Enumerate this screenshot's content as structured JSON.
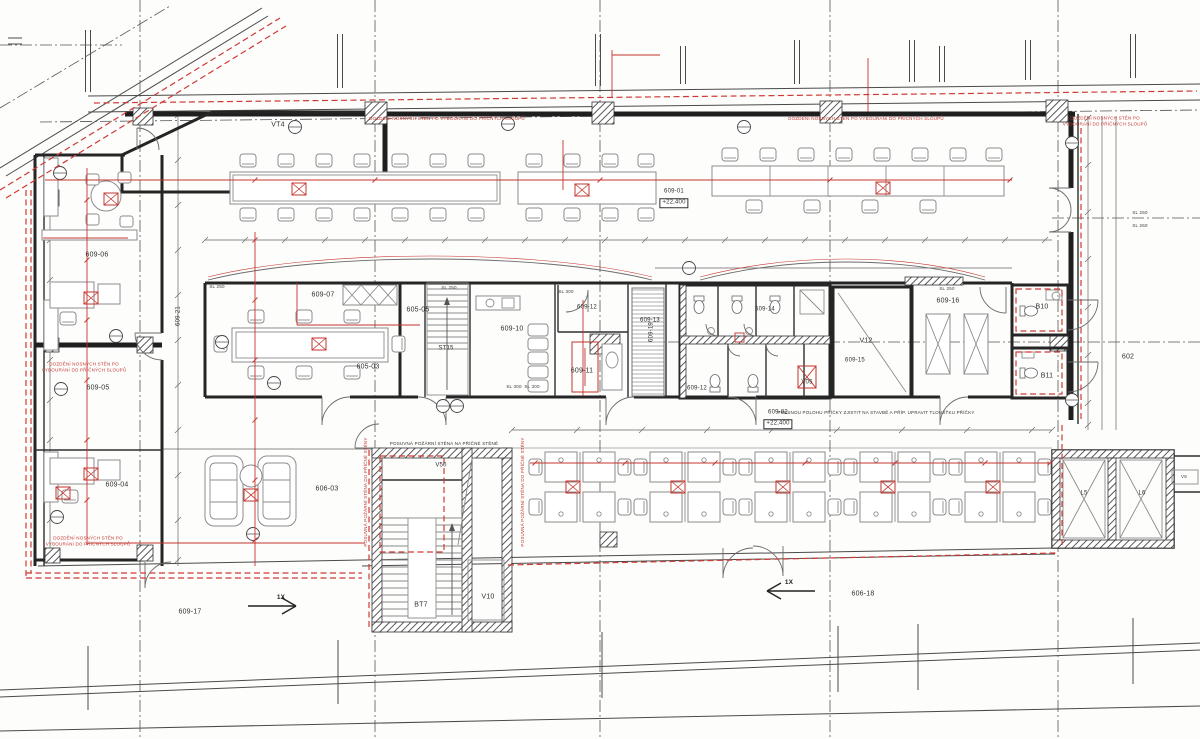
{
  "colors": {
    "accent_red": "#c4342e",
    "wall": "#252525",
    "furniture": "#8c8c8c"
  },
  "labels": [
    {
      "id": "room-vt4",
      "t": "VT4",
      "x": 278,
      "y": 126,
      "cls": "room"
    },
    {
      "id": "room-609-06",
      "t": "609-06",
      "x": 97,
      "y": 256,
      "cls": "room"
    },
    {
      "id": "room-609-21",
      "t": "609-21",
      "x": 179,
      "y": 316,
      "cls": "rsm",
      "r": -90
    },
    {
      "id": "room-609-05",
      "t": "609-05",
      "x": 98,
      "y": 389,
      "cls": "room"
    },
    {
      "id": "room-609-04",
      "t": "609-04",
      "x": 117,
      "y": 486,
      "cls": "room"
    },
    {
      "id": "room-609-07",
      "t": "609-07",
      "x": 323,
      "y": 296,
      "cls": "room"
    },
    {
      "id": "room-605-05",
      "t": "605-05",
      "x": 418,
      "y": 311,
      "cls": "room"
    },
    {
      "id": "room-605-03",
      "t": "605-03",
      "x": 368,
      "y": 368,
      "cls": "room"
    },
    {
      "id": "room-st15",
      "t": "ST15",
      "x": 446,
      "y": 349,
      "cls": "rsm"
    },
    {
      "id": "room-609-10",
      "t": "609-10",
      "x": 512,
      "y": 330,
      "cls": "room"
    },
    {
      "id": "room-609-12",
      "t": "609-12",
      "x": 587,
      "y": 308,
      "cls": "rsm"
    },
    {
      "id": "room-609-11",
      "t": "609-11",
      "x": 582,
      "y": 372,
      "cls": "room"
    },
    {
      "id": "room-609-13",
      "t": "609-13",
      "x": 650,
      "y": 321,
      "cls": "rsm"
    },
    {
      "id": "room-609-19",
      "t": "609-19",
      "x": 652,
      "y": 332,
      "cls": "rsm",
      "r": -90
    },
    {
      "id": "room-609-14",
      "t": "609-14",
      "x": 765,
      "y": 310,
      "cls": "rsm"
    },
    {
      "id": "room-609-15",
      "t": "609-15",
      "x": 855,
      "y": 361,
      "cls": "rsm"
    },
    {
      "id": "room-v12",
      "t": "V12",
      "x": 866,
      "y": 342,
      "cls": "room"
    },
    {
      "id": "room-v05",
      "t": "V05",
      "x": 807,
      "y": 383,
      "cls": "rsm"
    },
    {
      "id": "room-609-12b",
      "t": "609-12",
      "x": 697,
      "y": 389,
      "cls": "rsm"
    },
    {
      "id": "room-609-16",
      "t": "609-16",
      "x": 948,
      "y": 302,
      "cls": "room"
    },
    {
      "id": "room-b10",
      "t": "B10",
      "x": 1042,
      "y": 308,
      "cls": "room"
    },
    {
      "id": "room-b11",
      "t": "B11",
      "x": 1047,
      "y": 377,
      "cls": "room"
    },
    {
      "id": "room-602",
      "t": "602",
      "x": 1128,
      "y": 358,
      "cls": "room"
    },
    {
      "id": "room-609-01",
      "t": "609-01",
      "x": 674,
      "y": 192,
      "cls": "rsm"
    },
    {
      "id": "elev-609-01",
      "t": "+22,400",
      "x": 674,
      "y": 203,
      "cls": "elev"
    },
    {
      "id": "room-609-02",
      "t": "609-02",
      "x": 778,
      "y": 413,
      "cls": "rsm"
    },
    {
      "id": "elev-609-02",
      "t": "+22,400",
      "x": 778,
      "y": 424,
      "cls": "elev"
    },
    {
      "id": "room-606-03",
      "t": "606-03",
      "x": 327,
      "y": 490,
      "cls": "room"
    },
    {
      "id": "room-v50",
      "t": "V50",
      "x": 441,
      "y": 466,
      "cls": "rsm"
    },
    {
      "id": "room-bt7",
      "t": "BT7",
      "x": 421,
      "y": 606,
      "cls": "room"
    },
    {
      "id": "room-v10",
      "t": "V10",
      "x": 488,
      "y": 598,
      "cls": "room"
    },
    {
      "id": "room-609-17",
      "t": "609-17",
      "x": 190,
      "y": 613,
      "cls": "room"
    },
    {
      "id": "room-606-18",
      "t": "606-18",
      "x": 863,
      "y": 595,
      "cls": "room"
    },
    {
      "id": "room-l5",
      "t": "L5",
      "x": 1084,
      "y": 494,
      "cls": "rsm"
    },
    {
      "id": "room-l6",
      "t": "L6",
      "x": 1142,
      "y": 494,
      "cls": "rsm"
    },
    {
      "id": "room-v8",
      "t": "V8",
      "x": 1184,
      "y": 477,
      "cls": "tiny"
    },
    {
      "id": "axis-1x-left",
      "t": "1X",
      "x": 281,
      "y": 598,
      "cls": "axis"
    },
    {
      "id": "axis-1x-right",
      "t": "1X",
      "x": 789,
      "y": 583,
      "cls": "axis"
    },
    {
      "id": "dim-sl250-a",
      "t": "SL 250",
      "x": 217,
      "y": 287,
      "cls": "tiny"
    },
    {
      "id": "dim-sl250-b",
      "t": "SL 250",
      "x": 449,
      "y": 288,
      "cls": "tiny"
    },
    {
      "id": "dim-sl300-a",
      "t": "SL 300",
      "x": 566,
      "y": 292,
      "cls": "tiny"
    },
    {
      "id": "dim-sl300-b",
      "t": "SL 300",
      "x": 514,
      "y": 387,
      "cls": "tiny"
    },
    {
      "id": "dim-sl300-c",
      "t": "SL 300",
      "x": 532,
      "y": 387,
      "cls": "tiny"
    },
    {
      "id": "dim-sl250-c",
      "t": "SL 250",
      "x": 947,
      "y": 289,
      "cls": "tiny"
    },
    {
      "id": "dim-sl250-d",
      "t": "SL 250",
      "x": 1140,
      "y": 213,
      "cls": "tiny"
    },
    {
      "id": "dim-sl260",
      "t": "SL 260",
      "x": 1140,
      "y": 226,
      "cls": "tiny"
    },
    {
      "id": "note-red-top-1",
      "t": "DOZDĚNÍ NOSNÝCH STĚN PO VYBOURÁNÍ DO PŘÍČNÝCH SLOUPŮ",
      "x": 447,
      "y": 119,
      "cls": "note-red"
    },
    {
      "id": "note-red-top-2",
      "t": "DOZDĚNÍ NOSNÝCH STĚN PO VYBOURÁNÍ DO PŘÍČNÝCH SLOUPŮ",
      "x": 866,
      "y": 119,
      "cls": "note-red"
    },
    {
      "id": "note-red-top-3",
      "t": "DOZDĚNÍ NOSNÝCH STĚN PO VYBOURÁNÍ DO PŘÍČNÝCH SLOUPŮ",
      "x": 1105,
      "y": 121,
      "cls": "note-red"
    },
    {
      "id": "note-red-left-1",
      "t": "DOZDĚNÍ NOSNÝCH STĚN PO\nVYBOURÁNÍ DO PŘÍČNÝCH SLOUPŮ",
      "x": 84,
      "y": 367,
      "cls": "note-red"
    },
    {
      "id": "note-red-left-2",
      "t": "DOZDĚNÍ NOSNÝCH STĚN PO\nVYBOURÁNÍ DO PŘÍČNÝCH SLOUPŮ",
      "x": 88,
      "y": 541,
      "cls": "note-red"
    },
    {
      "id": "note-red-stair-left",
      "t": "POSUVNÁ POŽÁRNÍ STĚNA DO PŘÍČNÉ STĚNY",
      "x": 366,
      "y": 492,
      "cls": "note-red",
      "r": -90
    },
    {
      "id": "note-red-stair-right",
      "t": "POSUVNÁ POŽÁRNÍ STĚNA DO PŘÍČNÉ STĚNY",
      "x": 523,
      "y": 492,
      "cls": "note-red",
      "r": -90
    },
    {
      "id": "note-black-stair",
      "t": "POSUVNÁ POŽÁRNÍ STĚNA NA PŘÍČNÉ STĚNĚ",
      "x": 444,
      "y": 444,
      "cls": "note-black"
    },
    {
      "id": "note-black-pricka",
      "t": "PŘESNOU POLOHU PŘÍČKY ZJISTIT NA STAVBĚ A PŘÍP. UPRAVIT TLOUŠŤKU PŘÍČKY",
      "x": 876,
      "y": 413,
      "cls": "note-black"
    }
  ]
}
